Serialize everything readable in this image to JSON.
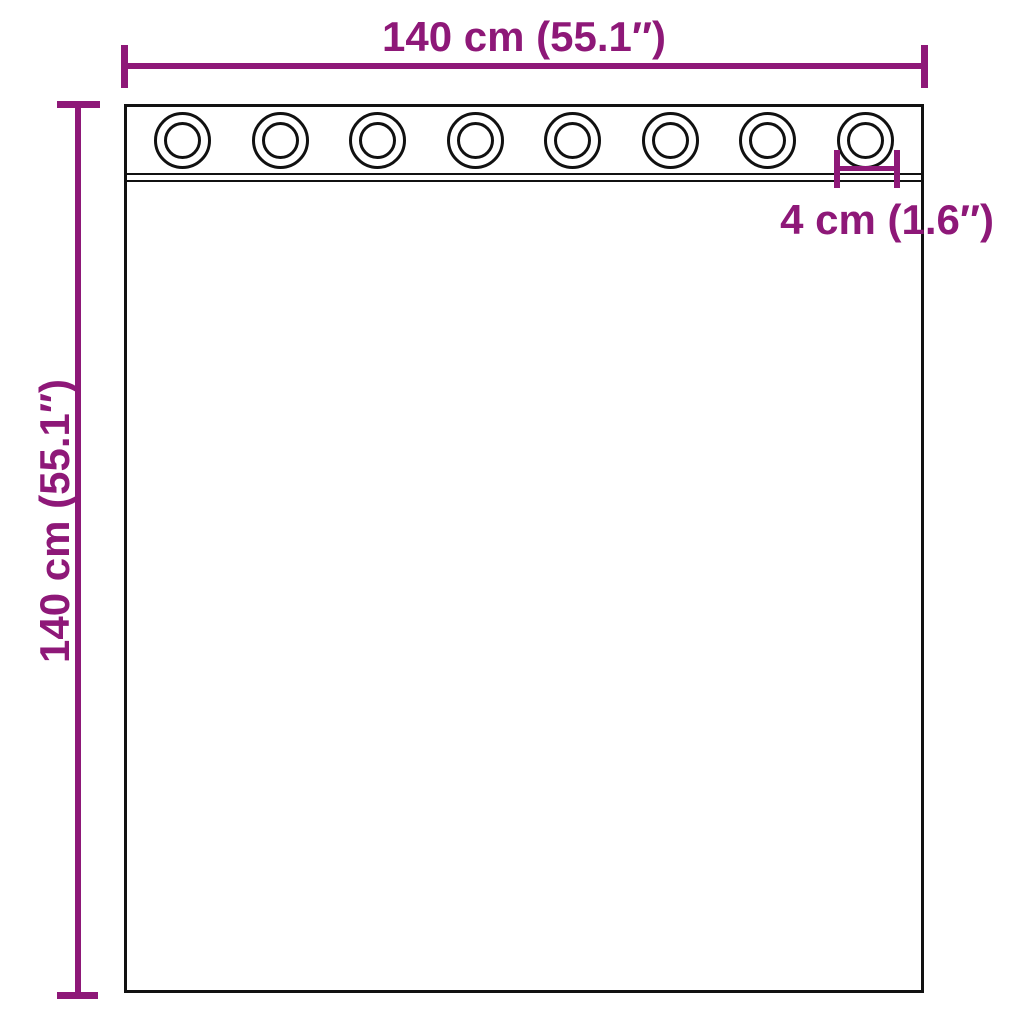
{
  "diagram": {
    "subject": "curtain-with-grommets-dimension-diagram",
    "width_label": "140 cm (55.1″)",
    "height_label": "140 cm (55.1″)",
    "grommet_label": "4 cm (1.6″)",
    "grommet_count": 8,
    "colors": {
      "dimension_lines": "#8E1878",
      "outline": "#111111",
      "background": "#FFFFFF"
    }
  }
}
